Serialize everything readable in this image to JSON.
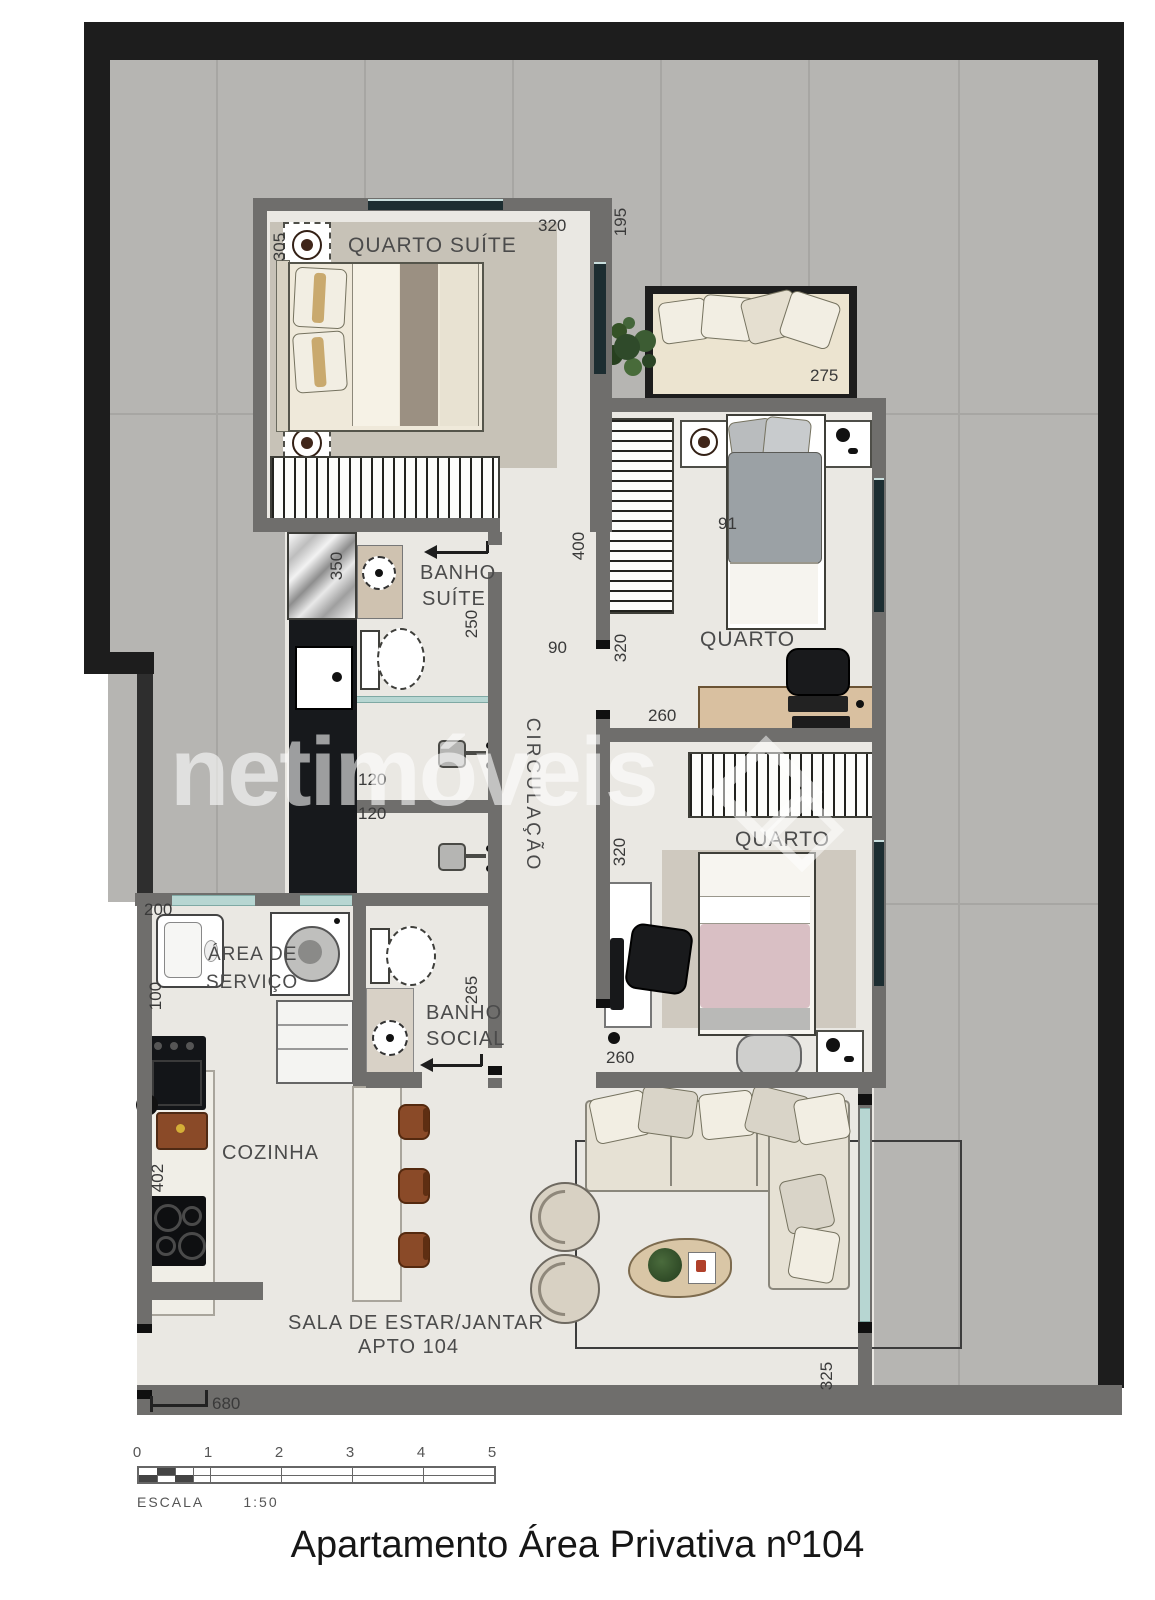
{
  "palette": {
    "outer_wall": "#1d1d1d",
    "inner_wall": "#6f6e6c",
    "terrace_tile": "#b6b5b2",
    "floor": "#eae8e3",
    "window_glass": "#b7d6d2",
    "accent_wood": "#8a4a28",
    "plant_green": "#3c5c33"
  },
  "watermark": {
    "text": "netimóveis"
  },
  "rooms": [
    {
      "label": "QUARTO SUÍTE"
    },
    {
      "line1": "BANHO",
      "line2": "SUÍTE"
    },
    {
      "label": "CIRCULAÇÃO"
    },
    {
      "label": "QUARTO"
    },
    {
      "label": "QUARTO"
    },
    {
      "line1": "ÁREA DE",
      "line2": "SERVIÇO"
    },
    {
      "line1": "BANHO",
      "line2": "SOCIAL"
    },
    {
      "label": "COZINHA"
    },
    {
      "line1": "SALA DE ESTAR/JANTAR",
      "line2": "APTO 104"
    }
  ],
  "dimensions": [
    {
      "value": "305"
    },
    {
      "value": "320"
    },
    {
      "value": "195"
    },
    {
      "value": "275"
    },
    {
      "value": "350"
    },
    {
      "value": "250"
    },
    {
      "value": "400"
    },
    {
      "value": "90"
    },
    {
      "value": "320"
    },
    {
      "value": "260"
    },
    {
      "value": "91"
    },
    {
      "value": "120"
    },
    {
      "value": "120"
    },
    {
      "value": "320"
    },
    {
      "value": "200"
    },
    {
      "value": "100"
    },
    {
      "value": "265"
    },
    {
      "value": "260"
    },
    {
      "value": "402"
    },
    {
      "value": "680"
    },
    {
      "value": "325"
    }
  ],
  "scale_bar": {
    "label": "ESCALA",
    "ratio": "1:50",
    "ticks": [
      "0",
      "1",
      "2",
      "3",
      "4",
      "5"
    ]
  },
  "footer": {
    "title": "Apartamento Área Privativa nº104"
  }
}
